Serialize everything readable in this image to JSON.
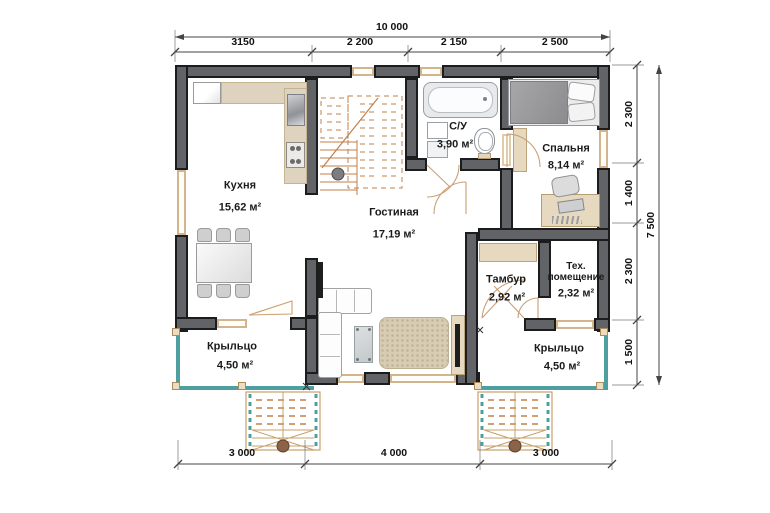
{
  "plan": {
    "type": "floor-plan",
    "units": "mm",
    "rooms": {
      "kitchen": {
        "name": "Кухня",
        "area": "15,62 м²"
      },
      "living": {
        "name": "Гостиная",
        "area": "17,19 м²"
      },
      "bathroom": {
        "name": "С/У",
        "area": "3,90 м²"
      },
      "bedroom": {
        "name": "Спальня",
        "area": "8,14 м²"
      },
      "tambour": {
        "name": "Тамбур",
        "area": "2,92 м²"
      },
      "tech": {
        "name_line1": "Тех.",
        "name_line2": "помещение",
        "area": "2,32 м²"
      },
      "porch_left": {
        "name": "Крыльцо",
        "area": "4,50 м²"
      },
      "porch_right": {
        "name": "Крыльцо",
        "area": "4,50 м²"
      }
    },
    "dimensions": {
      "top_total": "10 000",
      "top_segments": [
        "3150",
        "2 200",
        "2 150",
        "2 500"
      ],
      "right_segments": [
        "2 300",
        "1 400",
        "2 300",
        "1 500"
      ],
      "right_total": "7 500",
      "bottom_segments": [
        "3 000",
        "4 000",
        "3 000"
      ]
    },
    "colors": {
      "wall": "#616366",
      "wall_edge": "#1b1c1e",
      "window_frame": "#d3b48c",
      "porch_rail": "#4f9fa0",
      "stairs": "#c28049",
      "rug": "#d8cdb4",
      "counter": "#ded3bf",
      "dimension_text": "#111111"
    }
  }
}
